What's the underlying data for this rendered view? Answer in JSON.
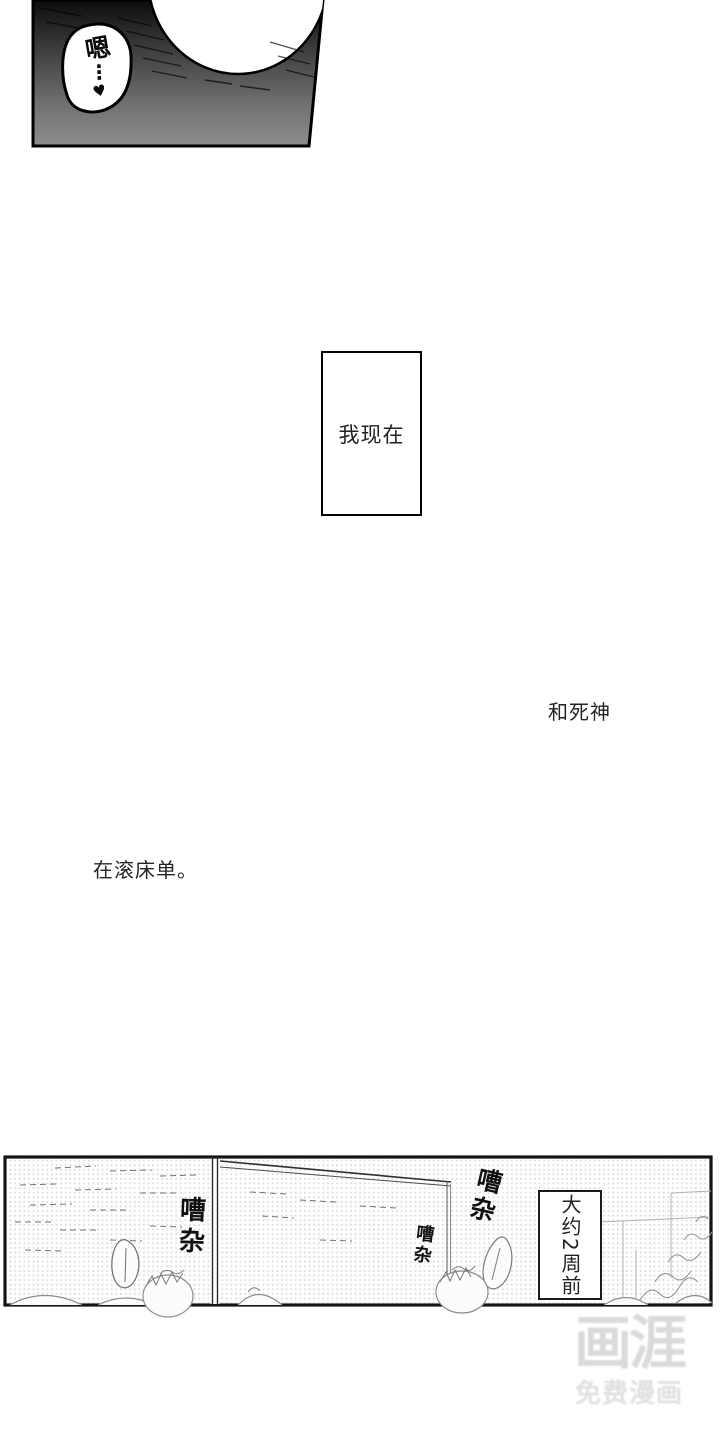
{
  "panels": {
    "top": {
      "speech_bubble": {
        "text": "嗯",
        "dots": "⋮",
        "heart": "♥"
      }
    },
    "narration": {
      "box_text": "我现在",
      "right_text": "和死神",
      "left_text": "在滚床单。"
    },
    "bottom": {
      "sfx": [
        {
          "label": "嘈杂"
        },
        {
          "label": "嘈杂"
        },
        {
          "label": "嘈杂"
        }
      ],
      "time_box": "大约2周前"
    }
  },
  "watermark": {
    "logo": "画涯",
    "tagline": "免费漫画"
  },
  "colors": {
    "page_bg": "#ffffff",
    "ink": "#111111",
    "panel_gradient_top": "#0b0b0b",
    "panel_gradient_bottom": "#8d8d8d",
    "halftone_dot": "#cfcfcf",
    "watermark_gray": "#dadada"
  }
}
